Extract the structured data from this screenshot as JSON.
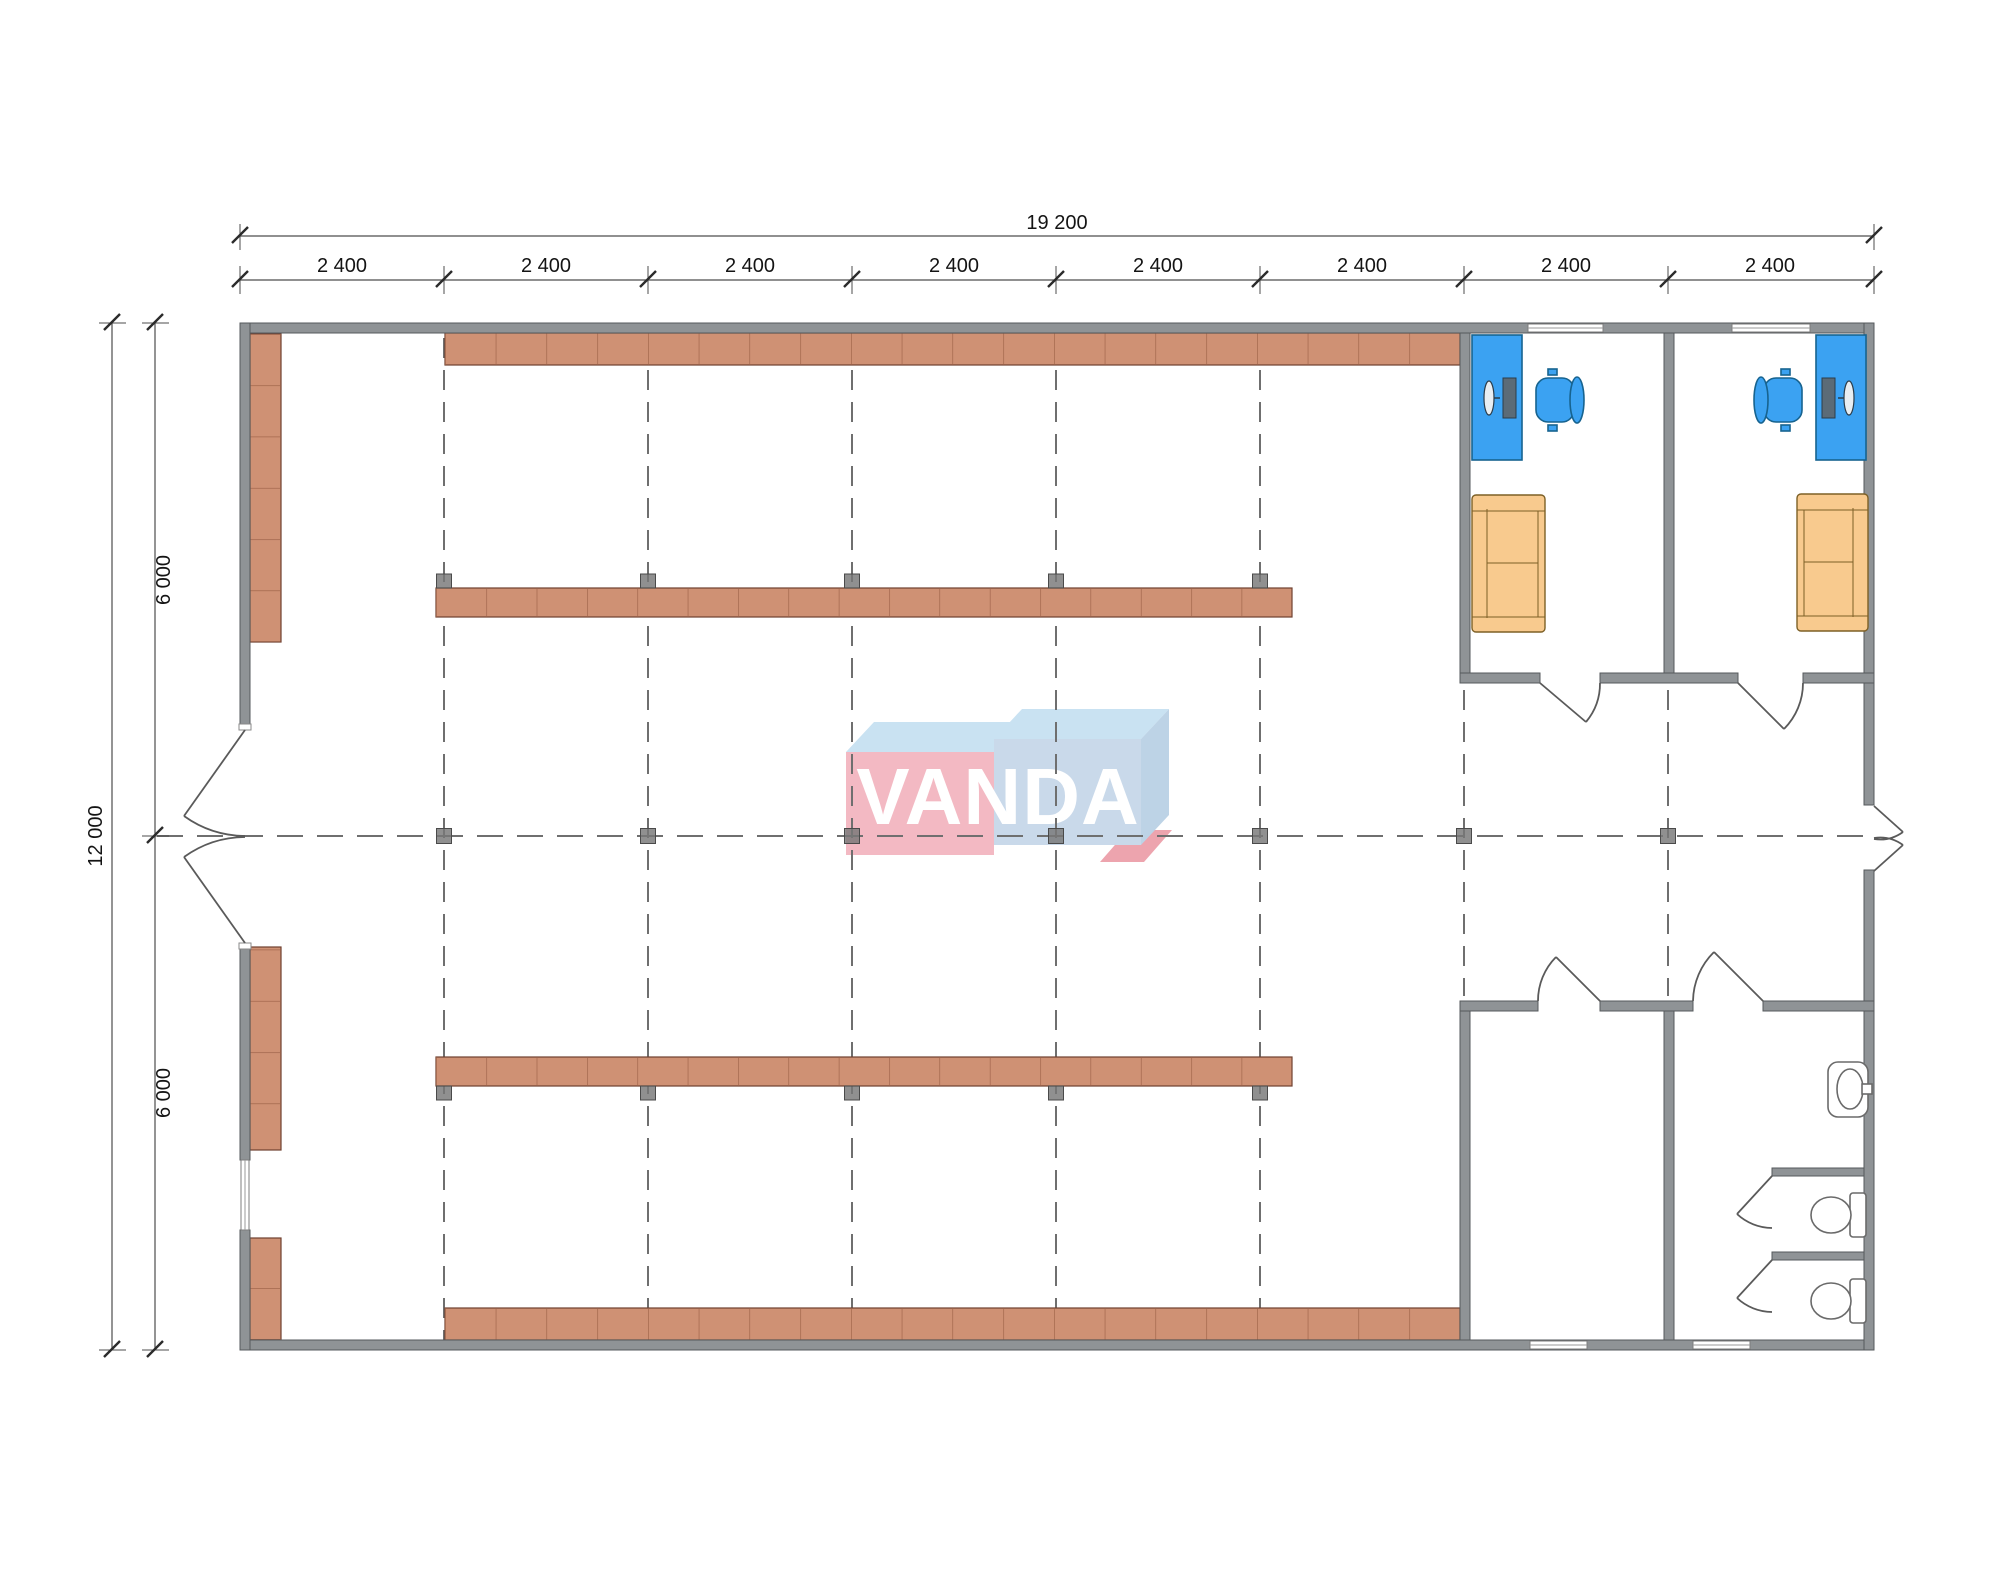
{
  "drawing": {
    "type": "architectural-floor-plan",
    "logo": {
      "text": "VANDA"
    },
    "dimensions": {
      "total_width_label": "19 200",
      "bay_labels": [
        "2 400",
        "2 400",
        "2 400",
        "2 400",
        "2 400",
        "2 400",
        "2 400",
        "2 400"
      ],
      "total_height_label": "12 000",
      "half_height_labels": [
        "6 000",
        "6 000"
      ]
    }
  },
  "colors": {
    "wall": "#8f9396",
    "wall_stroke": "#55595c",
    "shelf": "#cf9174",
    "shelf_stroke": "#6f4030",
    "shelf_divider": "#9a5f45",
    "desk": "#3ba2f2",
    "desk_stroke": "#17638f",
    "sofa": "#f8ca8e",
    "sofa_stroke": "#7d6026",
    "grid": "#6f6f6f",
    "marker": "#787878",
    "marker_stroke": "#4a4a4a",
    "dim": "#4d4d4d",
    "tick": "#2b2b2b",
    "text": "#141414",
    "fixture_stroke": "#6a6a6a",
    "logo_pink": "#f3b9c3",
    "logo_pink_dark": "#eda4ae",
    "logo_blue_top": "#c9e2f2",
    "logo_blue_front": "#c9d9ea",
    "logo_blue_side": "#bdd3e6"
  }
}
